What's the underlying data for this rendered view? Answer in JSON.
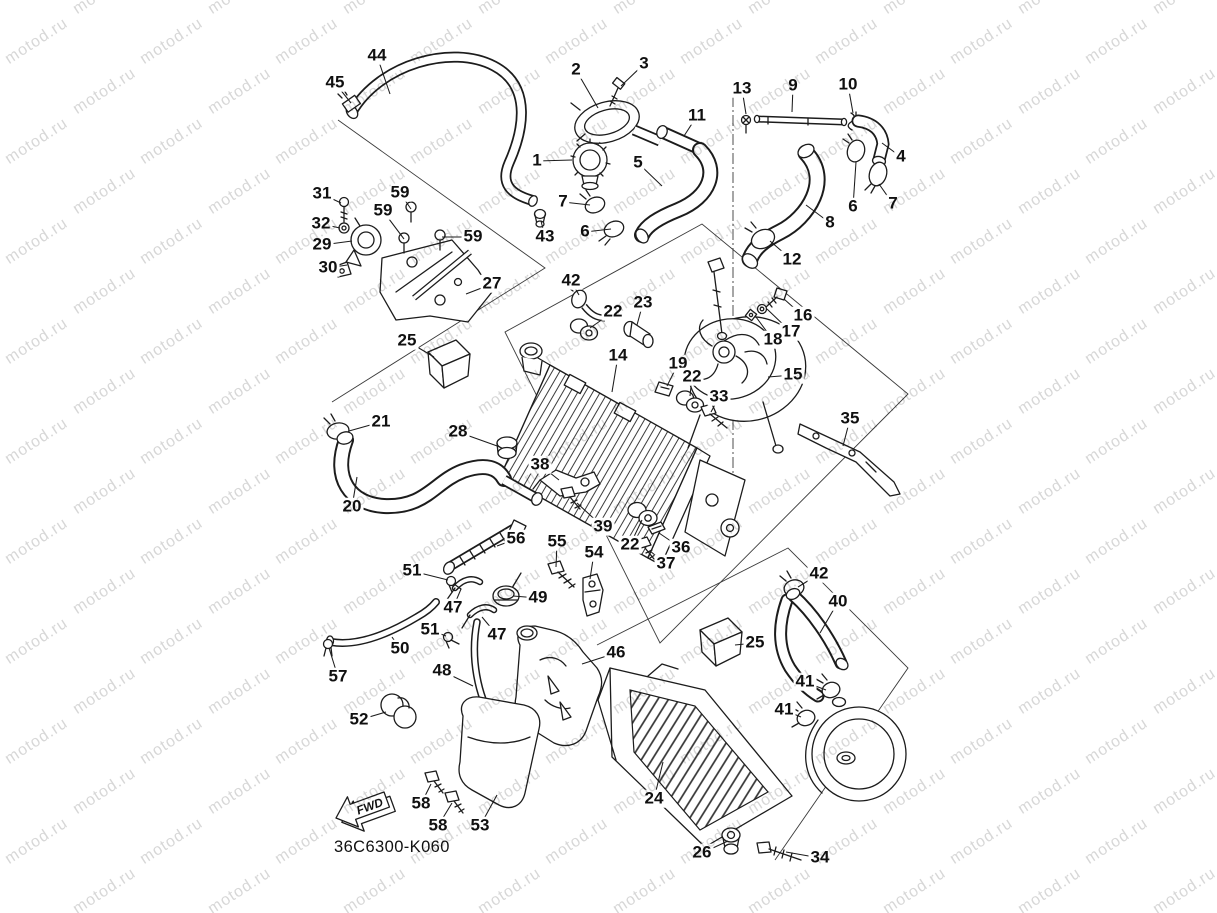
{
  "diagram": {
    "part_code": "36C6300-K060",
    "fwd_label": "FWD",
    "callouts": [
      {
        "n": "44",
        "x": 377,
        "y": 56,
        "tx": 390,
        "ty": 94
      },
      {
        "n": "45",
        "x": 335,
        "y": 83,
        "tx": 351,
        "ty": 103
      },
      {
        "n": "2",
        "x": 576,
        "y": 70,
        "tx": 598,
        "ty": 108
      },
      {
        "n": "3",
        "x": 644,
        "y": 64,
        "tx": 621,
        "ty": 86
      },
      {
        "n": "1",
        "x": 537,
        "y": 161,
        "tx": 572,
        "ty": 160
      },
      {
        "n": "5",
        "x": 638,
        "y": 163,
        "tx": 662,
        "ty": 186
      },
      {
        "n": "7",
        "x": 563,
        "y": 202,
        "tx": 590,
        "ty": 205
      },
      {
        "n": "6",
        "x": 585,
        "y": 232,
        "tx": 611,
        "ty": 229
      },
      {
        "n": "11",
        "x": 697,
        "y": 116,
        "tx": 684,
        "ty": 136
      },
      {
        "n": "43",
        "x": 545,
        "y": 237,
        "tx": 541,
        "ty": 221
      },
      {
        "n": "13",
        "x": 742,
        "y": 89,
        "tx": 746,
        "ty": 114
      },
      {
        "n": "9",
        "x": 793,
        "y": 86,
        "tx": 792,
        "ty": 112
      },
      {
        "n": "10",
        "x": 848,
        "y": 85,
        "tx": 853,
        "ty": 113
      },
      {
        "n": "4",
        "x": 901,
        "y": 157,
        "tx": 882,
        "ty": 143
      },
      {
        "n": "6",
        "x": 853,
        "y": 207,
        "tx": 856,
        "ty": 162
      },
      {
        "n": "7",
        "x": 893,
        "y": 204,
        "tx": 879,
        "ty": 184
      },
      {
        "n": "8",
        "x": 830,
        "y": 223,
        "tx": 806,
        "ty": 205
      },
      {
        "n": "12",
        "x": 792,
        "y": 260,
        "tx": 770,
        "ty": 241
      },
      {
        "n": "31",
        "x": 322,
        "y": 194,
        "tx": 341,
        "ty": 203
      },
      {
        "n": "59",
        "x": 400,
        "y": 193,
        "tx": 411,
        "ty": 209
      },
      {
        "n": "59",
        "x": 383,
        "y": 211,
        "tx": 404,
        "ty": 239
      },
      {
        "n": "32",
        "x": 321,
        "y": 224,
        "tx": 340,
        "ty": 228
      },
      {
        "n": "29",
        "x": 322,
        "y": 245,
        "tx": 352,
        "ty": 241
      },
      {
        "n": "59",
        "x": 473,
        "y": 237,
        "tx": 442,
        "ty": 237
      },
      {
        "n": "30",
        "x": 328,
        "y": 268,
        "tx": 347,
        "ty": 265
      },
      {
        "n": "27",
        "x": 492,
        "y": 284,
        "tx": 466,
        "ty": 294
      },
      {
        "n": "42",
        "x": 571,
        "y": 281,
        "tx": 579,
        "ty": 295
      },
      {
        "n": "22",
        "x": 613,
        "y": 312,
        "tx": 590,
        "ty": 328
      },
      {
        "n": "23",
        "x": 643,
        "y": 303,
        "tx": 637,
        "ty": 325
      },
      {
        "n": "16",
        "x": 803,
        "y": 316,
        "tx": 784,
        "ty": 299
      },
      {
        "n": "17",
        "x": 791,
        "y": 332,
        "tx": 767,
        "ty": 309
      },
      {
        "n": "18",
        "x": 773,
        "y": 340,
        "tx": 756,
        "ty": 317
      },
      {
        "n": "14",
        "x": 618,
        "y": 356,
        "tx": 612,
        "ty": 392
      },
      {
        "n": "19",
        "x": 678,
        "y": 364,
        "tx": 667,
        "ty": 386
      },
      {
        "n": "22",
        "x": 692,
        "y": 377,
        "tx": 690,
        "ty": 396
      },
      {
        "n": "15",
        "x": 793,
        "y": 375,
        "tx": 768,
        "ty": 377
      },
      {
        "n": "33",
        "x": 719,
        "y": 397,
        "tx": 711,
        "ty": 412
      },
      {
        "n": "35",
        "x": 850,
        "y": 419,
        "tx": 843,
        "ty": 446
      },
      {
        "n": "25",
        "x": 407,
        "y": 341,
        "tx": 434,
        "ty": 357
      },
      {
        "n": "21",
        "x": 381,
        "y": 422,
        "tx": 349,
        "ty": 431
      },
      {
        "n": "28",
        "x": 458,
        "y": 432,
        "tx": 500,
        "ty": 447
      },
      {
        "n": "20",
        "x": 352,
        "y": 507,
        "tx": 357,
        "ty": 477
      },
      {
        "n": "38",
        "x": 540,
        "y": 465,
        "tx": 559,
        "ty": 480
      },
      {
        "n": "39",
        "x": 603,
        "y": 527,
        "tx": 577,
        "ty": 503
      },
      {
        "n": "22",
        "x": 630,
        "y": 545,
        "tx": 642,
        "ty": 520
      },
      {
        "n": "36",
        "x": 681,
        "y": 548,
        "tx": 659,
        "ty": 533
      },
      {
        "n": "37",
        "x": 666,
        "y": 564,
        "tx": 650,
        "ty": 551
      },
      {
        "n": "56",
        "x": 516,
        "y": 539,
        "tx": 497,
        "ty": 546
      },
      {
        "n": "55",
        "x": 557,
        "y": 542,
        "tx": 556,
        "ty": 567
      },
      {
        "n": "54",
        "x": 594,
        "y": 553,
        "tx": 590,
        "ty": 579
      },
      {
        "n": "51",
        "x": 412,
        "y": 571,
        "tx": 448,
        "ty": 580
      },
      {
        "n": "47",
        "x": 453,
        "y": 608,
        "tx": 461,
        "ty": 589
      },
      {
        "n": "49",
        "x": 538,
        "y": 598,
        "tx": 513,
        "ty": 596
      },
      {
        "n": "51",
        "x": 430,
        "y": 630,
        "tx": 446,
        "ty": 636
      },
      {
        "n": "47",
        "x": 497,
        "y": 635,
        "tx": 482,
        "ty": 617
      },
      {
        "n": "50",
        "x": 400,
        "y": 649,
        "tx": 392,
        "ty": 637
      },
      {
        "n": "57",
        "x": 338,
        "y": 677,
        "tx": 329,
        "ty": 648
      },
      {
        "n": "48",
        "x": 442,
        "y": 671,
        "tx": 473,
        "ty": 686
      },
      {
        "n": "46",
        "x": 616,
        "y": 653,
        "tx": 582,
        "ty": 664
      },
      {
        "n": "42",
        "x": 819,
        "y": 574,
        "tx": 798,
        "ty": 587
      },
      {
        "n": "40",
        "x": 838,
        "y": 602,
        "tx": 820,
        "ty": 633
      },
      {
        "n": "25",
        "x": 755,
        "y": 643,
        "tx": 735,
        "ty": 645
      },
      {
        "n": "41",
        "x": 805,
        "y": 682,
        "tx": 826,
        "ty": 690
      },
      {
        "n": "41",
        "x": 784,
        "y": 710,
        "tx": 801,
        "ty": 717
      },
      {
        "n": "24",
        "x": 654,
        "y": 799,
        "tx": 663,
        "ty": 762
      },
      {
        "n": "52",
        "x": 359,
        "y": 720,
        "tx": 386,
        "ty": 712
      },
      {
        "n": "58",
        "x": 421,
        "y": 804,
        "tx": 431,
        "ty": 784
      },
      {
        "n": "58",
        "x": 438,
        "y": 826,
        "tx": 452,
        "ty": 803
      },
      {
        "n": "53",
        "x": 480,
        "y": 826,
        "tx": 497,
        "ty": 795
      },
      {
        "n": "26",
        "x": 702,
        "y": 853,
        "tx": 728,
        "ty": 841
      },
      {
        "n": "34",
        "x": 820,
        "y": 858,
        "tx": 786,
        "ty": 852
      }
    ]
  },
  "watermark": {
    "text": "motod.ru",
    "color": "#d7d7d7",
    "rotation_deg": -33,
    "font_size": 16,
    "cols": 10,
    "rows": 19,
    "col_spacing": 135,
    "row_spacing": 50,
    "row_offset": 67,
    "x_start": -60,
    "y_start": 2
  }
}
